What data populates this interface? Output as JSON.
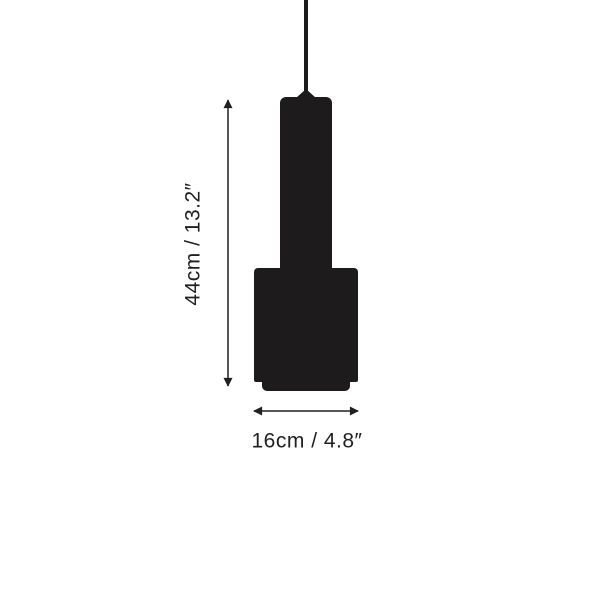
{
  "canvas": {
    "width_px": 600,
    "height_px": 600,
    "background_color": "#ffffff"
  },
  "diagram": {
    "type": "product-dimension-diagram",
    "subject": "pendant lamp silhouette",
    "silhouette_color": "#1d1b1b",
    "line_color": "#221f1f",
    "text_color": "#221f1f",
    "height_dimension": {
      "label": "44cm / 13.2″",
      "value_cm": 44,
      "value_in": 13.2,
      "orientation": "vertical"
    },
    "width_dimension": {
      "label": "16cm / 4.8″",
      "value_cm": 16,
      "value_in": 4.8,
      "orientation": "horizontal"
    }
  }
}
